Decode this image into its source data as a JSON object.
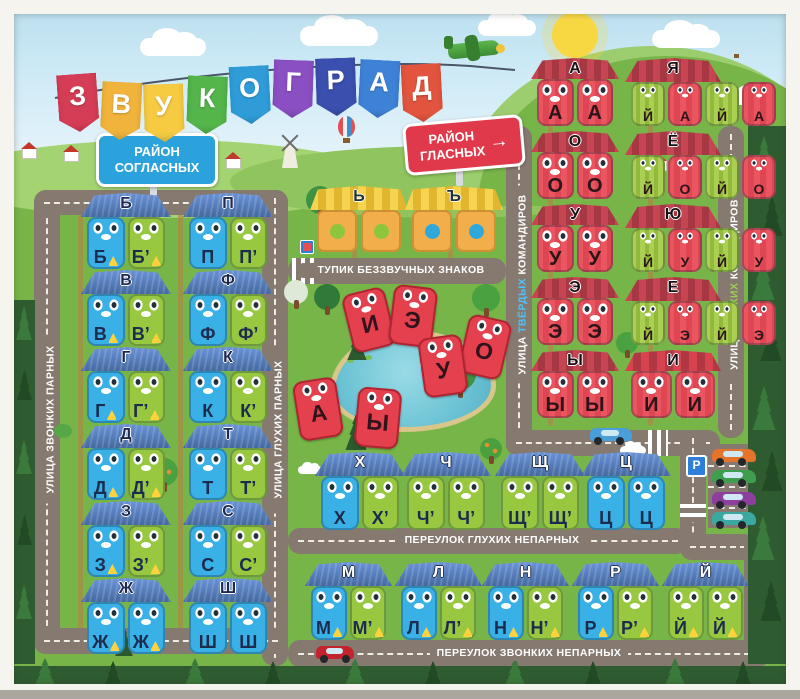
{
  "title": {
    "name": "ЗВУКОГРАД",
    "letters": [
      {
        "ch": "З",
        "color": "#d53c55"
      },
      {
        "ch": "В",
        "color": "#f0b43c"
      },
      {
        "ch": "У",
        "color": "#f6ca41"
      },
      {
        "ch": "К",
        "color": "#53b54a"
      },
      {
        "ch": "О",
        "color": "#2f9cd8"
      },
      {
        "ch": "Г",
        "color": "#8a4fc2"
      },
      {
        "ch": "Р",
        "color": "#3b4fae"
      },
      {
        "ch": "А",
        "color": "#3e82d8"
      },
      {
        "ch": "Д",
        "color": "#e2543d"
      }
    ]
  },
  "signs": {
    "consonant_district": {
      "line1": "РАЙОН",
      "line2": "СОГЛАСНЫХ",
      "color": "#2ca2dc"
    },
    "vowel_district": {
      "line1": "РАЙОН",
      "line2": "ГЛАСНЫХ",
      "arrow": "→",
      "color": "#e0394b"
    },
    "parking": "P"
  },
  "streets": {
    "voiced_paired": "УЛИЦА ЗВОНКИХ ПАРНЫХ",
    "voiceless_paired": "УЛИЦА ГЛУХИХ ПАРНЫХ",
    "hard": {
      "prefix": "УЛИЦА",
      "word": "ТВЁРДЫХ",
      "suffix": "КОМАНДИРОВ"
    },
    "soft": {
      "prefix": "УЛИЦА",
      "word": "МЯГКИХ",
      "suffix": "КОМАНДИРОВ"
    },
    "silent_deadend": "ТУПИК БЕЗЗВУЧНЫХ ЗНАКОВ",
    "voiceless_unpaired": "ПЕРЕУЛОК ГЛУХИХ НЕПАРНЫХ",
    "voiced_unpaired": "ПЕРЕУЛОК ЗВОНКИХ НЕПАРНЫХ"
  },
  "houses_left": [
    {
      "roof": "Б",
      "units": [
        {
          "letter": "Б",
          "bell": true
        },
        {
          "letter": "Б’",
          "bell": true
        }
      ]
    },
    {
      "roof": "П",
      "units": [
        {
          "letter": "П"
        },
        {
          "letter": "П’"
        }
      ]
    },
    {
      "roof": "В",
      "units": [
        {
          "letter": "В",
          "bell": true
        },
        {
          "letter": "В’",
          "bell": true
        }
      ]
    },
    {
      "roof": "Ф",
      "units": [
        {
          "letter": "Ф"
        },
        {
          "letter": "Ф’"
        }
      ]
    },
    {
      "roof": "Г",
      "units": [
        {
          "letter": "Г",
          "bell": true
        },
        {
          "letter": "Г’",
          "bell": true
        }
      ]
    },
    {
      "roof": "К",
      "units": [
        {
          "letter": "К"
        },
        {
          "letter": "К’"
        }
      ]
    },
    {
      "roof": "Д",
      "units": [
        {
          "letter": "Д",
          "bell": true
        },
        {
          "letter": "Д’",
          "bell": true
        }
      ]
    },
    {
      "roof": "Т",
      "units": [
        {
          "letter": "Т"
        },
        {
          "letter": "Т’"
        }
      ]
    },
    {
      "roof": "З",
      "units": [
        {
          "letter": "З",
          "bell": true
        },
        {
          "letter": "З’",
          "bell": true
        }
      ]
    },
    {
      "roof": "С",
      "units": [
        {
          "letter": "С"
        },
        {
          "letter": "С’"
        }
      ]
    },
    {
      "roof": "Ж",
      "units": [
        {
          "letter": "Ж",
          "bell": true
        },
        {
          "letter": "Ж",
          "bell": true
        }
      ]
    },
    {
      "roof": "Ш",
      "units": [
        {
          "letter": "Ш"
        },
        {
          "letter": "Ш"
        }
      ]
    }
  ],
  "lane_voiceless": [
    {
      "roof": "Х",
      "units": [
        {
          "letter": "Х"
        },
        {
          "letter": "Х’"
        }
      ]
    },
    {
      "roof": "Ч",
      "units": [
        {
          "letter": "Ч’"
        },
        {
          "letter": "Ч’"
        }
      ]
    },
    {
      "roof": "Щ",
      "units": [
        {
          "letter": "Щ’"
        },
        {
          "letter": "Щ’"
        }
      ]
    },
    {
      "roof": "Ц",
      "units": [
        {
          "letter": "Ц"
        },
        {
          "letter": "Ц"
        }
      ]
    }
  ],
  "lane_voiced": [
    {
      "roof": "М",
      "units": [
        {
          "letter": "М",
          "bell": true
        },
        {
          "letter": "М’",
          "bell": true
        }
      ]
    },
    {
      "roof": "Л",
      "units": [
        {
          "letter": "Л",
          "bell": true
        },
        {
          "letter": "Л’",
          "bell": true
        }
      ]
    },
    {
      "roof": "Н",
      "units": [
        {
          "letter": "Н",
          "bell": true
        },
        {
          "letter": "Н’",
          "bell": true
        }
      ]
    },
    {
      "roof": "Р",
      "units": [
        {
          "letter": "Р",
          "bell": true
        },
        {
          "letter": "Р’",
          "bell": true
        }
      ]
    },
    {
      "roof": "Й",
      "units": [
        {
          "letter": "Й",
          "bell": true
        },
        {
          "letter": "Й",
          "bell": true
        }
      ]
    }
  ],
  "vowels_hard": [
    {
      "roof": "А",
      "units": [
        "А",
        "А"
      ]
    },
    {
      "roof": "О",
      "units": [
        "О",
        "О"
      ]
    },
    {
      "roof": "У",
      "units": [
        "У",
        "У"
      ]
    },
    {
      "roof": "Э",
      "units": [
        "Э",
        "Э"
      ]
    },
    {
      "roof": "Ы",
      "units": [
        "Ы",
        "Ы"
      ]
    }
  ],
  "vowels_soft": [
    {
      "roof": "Я",
      "units": [
        "Й",
        "А",
        "Й",
        "А"
      ]
    },
    {
      "roof": "Ё",
      "units": [
        "Й",
        "О",
        "Й",
        "О"
      ]
    },
    {
      "roof": "Ю",
      "units": [
        "Й",
        "У",
        "Й",
        "У"
      ]
    },
    {
      "roof": "Е",
      "units": [
        "Й",
        "Э",
        "Й",
        "Э"
      ]
    }
  ],
  "vowel_i": {
    "roof": "И",
    "units": [
      "И",
      "И"
    ]
  },
  "sign_houses": [
    {
      "roof": "Ь",
      "dot_color": "#8cc63f"
    },
    {
      "roof": "Ъ",
      "dot_color": "#2fa9dc"
    }
  ],
  "pond_letters": [
    "И",
    "Э",
    "О",
    "У",
    "А",
    "Ы"
  ],
  "colors": {
    "grass": "#77b549",
    "road": "#86796f",
    "sky": "#c3e4f2",
    "house_blue": "#39b1e6",
    "house_green": "#97c840",
    "house_red": "#e8505b",
    "house_yellow": "#f1ae4b",
    "roof_blue": "#4c7ecf",
    "roof_red": "#b8404e",
    "bell": "#ffd23d"
  }
}
